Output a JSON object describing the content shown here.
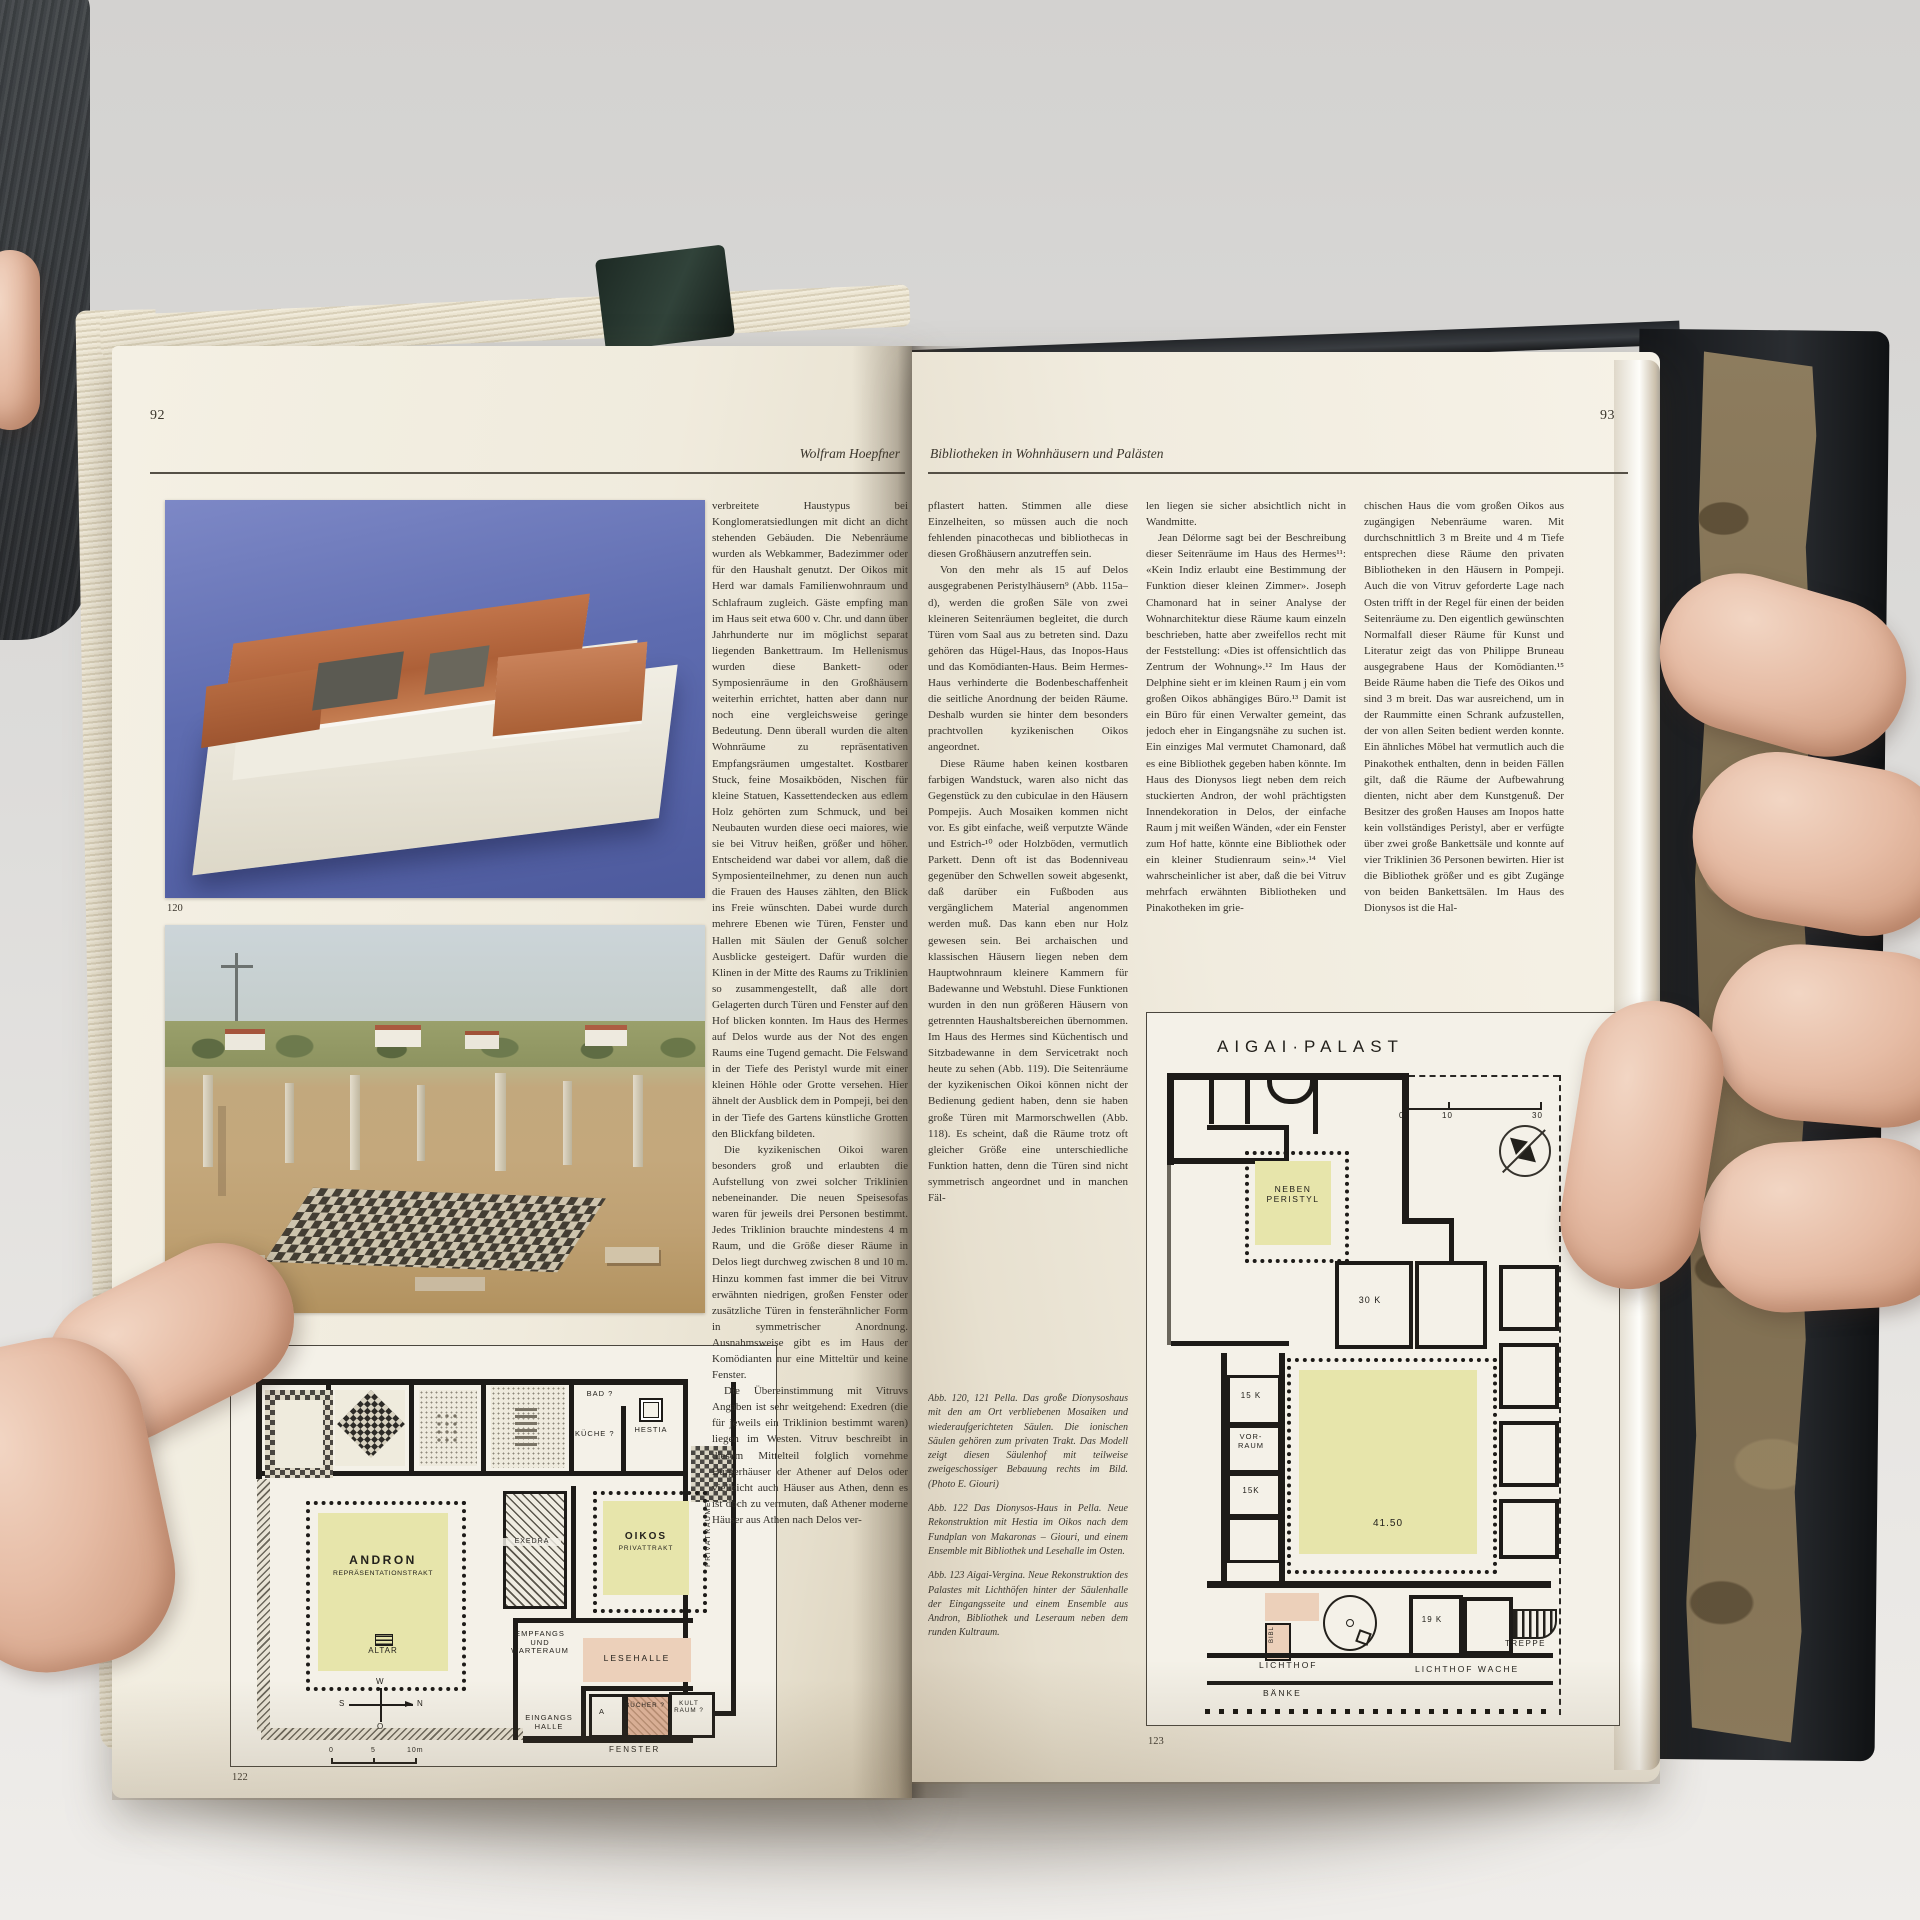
{
  "book": {
    "left_page": {
      "page_number": "92",
      "running_head": "Wolfram Hoepfner",
      "text": {
        "p1": "verbreitete Haustypus bei Konglomeratsiedlungen mit dicht an dicht stehenden Gebäuden. Die Nebenräume wurden als Webkammer, Badezimmer oder für den Haushalt genutzt. Der Oikos mit Herd war damals Familienwohnraum und Schlafraum zugleich. Gäste empfing man im Haus seit etwa 600 v. Chr. und dann über Jahrhunderte nur im möglichst separat liegenden Bankettraum. Im Hellenismus wurden diese Bankett- oder Symposienräume in den Großhäusern weiterhin errichtet, hatten aber dann nur noch eine vergleichsweise geringe Bedeutung. Denn überall wurden die alten Wohnräume zu repräsentativen Empfangsräumen umgestaltet. Kostbarer Stuck, feine Mosaikböden, Nischen für kleine Statuen, Kassettendecken aus edlem Holz gehörten zum Schmuck, und bei Neubauten wurden diese oeci maiores, wie sie bei Vitruv heißen, größer und höher. Entscheidend war dabei vor allem, daß die Symposienteilnehmer, zu denen nun auch die Frauen des Hauses zählten, den Blick ins Freie wünschten. Dabei wurde durch mehrere Ebenen wie Türen, Fenster und Hallen mit Säulen der Genuß solcher Ausblicke gesteigert. Dafür wurden die Klinen in der Mitte des Raums zu Triklinien so zusammengestellt, daß alle dort Gelagerten durch Türen und Fenster auf den Hof blicken konnten. Im Haus des Hermes auf Delos wurde aus der Not des engen Raums eine Tugend gemacht. Die Felswand in der Tiefe des Peristyl wurde mit einer kleinen Höhle oder Grotte versehen. Hier ähnelt der Ausblick dem in Pompeji, bei den in der Tiefe des Gartens künstliche Grotten den Blickfang bildeten.",
        "p2": "Die kyzikenischen Oikoi waren besonders groß und erlaubten die Aufstellung von zwei solcher Triklinien nebeneinander. Die neuen Speisesofas waren für jeweils drei Personen bestimmt. Jedes Triklinion brauchte mindestens 4 m Raum, und die Größe dieser Räume in Delos liegt durchweg zwischen 8 und 10 m. Hinzu kommen fast immer die bei Vitruv erwähnten niedrigen, großen Fenster oder zusätzliche Türen in fensterähnlicher Form in symmetrischer Anordnung. Ausnahmsweise gibt es im Haus der Komödianten nur eine Mitteltür und keine Fenster.",
        "p3": "Die Übereinstimmung mit Vitruvs Angaben ist sehr weitgehend: Exedren (die für jeweils ein Triklinion bestimmt waren) liegen im Westen. Vitruv beschreibt in diesem Mittelteil folglich vornehme Bürgerhäuser der Athener auf Delos oder vielleicht auch Häuser aus Athen, denn es ist doch zu vermuten, daß Athener moderne Häuser aus Athen nach Delos ver-"
      },
      "fig120": {
        "number": "120"
      },
      "fig121": {
        "number": "121"
      },
      "fig122": {
        "number": "122",
        "labels": {
          "bad": "BAD ?",
          "kueche": "KÜCHE ?",
          "hestia": "HESTIA",
          "andron": "ANDRON",
          "andron_sub": "REPRÄSENTATIONSTRAKT",
          "altar": "ALTAR",
          "exedra": "EXEDRA",
          "oikos": "OIKOS",
          "oikos_sub": "PRIVATTRAKT",
          "privatraeume": "PRIVATRÄUME",
          "empfangs": "EMPFANGS UND WARTERAUM",
          "lesehalle": "LESEHALLE",
          "a_room": "A",
          "buecher": "BÜCHER ?",
          "kultraum": "KULT RAUM ?",
          "eingangs": "EINGANGS HALLE",
          "fenster": "FENSTER"
        },
        "compass": {
          "top": "W",
          "right": "N",
          "left": "S",
          "bottom": "O"
        },
        "scale": {
          "s0": "0",
          "s5": "5",
          "s10": "10m"
        }
      }
    },
    "right_page": {
      "page_number": "93",
      "running_head": "Bibliotheken in Wohnhäusern und Palästen",
      "col1": {
        "p1": "pflastert hatten. Stimmen alle diese Einzelheiten, so müssen auch die noch fehlenden pinacothecas und bibliothecas in diesen Großhäusern anzutreffen sein.",
        "p2": "Von den mehr als 15 auf Delos ausgegrabenen Peristylhäusern⁹ (Abb. 115a–d), werden die großen Säle von zwei kleineren Seitenräumen begleitet, die durch Türen vom Saal aus zu betreten sind. Dazu gehören das Hügel-Haus, das Inopos-Haus und das Komödianten-Haus. Beim Hermes-Haus verhinderte die Bodenbeschaffenheit die seitliche Anordnung der beiden Räume. Deshalb wurden sie hinter dem besonders prachtvollen kyzikenischen Oikos angeordnet.",
        "p3": "Diese Räume haben keinen kostbaren farbigen Wandstuck, waren also nicht das Gegenstück zu den cubiculae in den Häusern Pompejis. Auch Mosaiken kommen nicht vor. Es gibt einfache, weiß verputzte Wände und Estrich-¹⁰ oder Holzböden, vermutlich Parkett. Denn oft ist das Bodenniveau gegenüber den Schwellen soweit abgesenkt, daß darüber ein Fußboden aus vergänglichem Material angenommen werden muß. Das kann eben nur Holz gewesen sein. Bei archaischen und klassischen Häusern liegen neben dem Hauptwohnraum kleinere Kammern für Badewanne und Webstuhl. Diese Funktionen wurden in den nun größeren Häusern von getrennten Haushaltsbereichen übernommen. Im Haus des Hermes sind Küchentisch und Sitzbadewanne in dem Servicetrakt noch heute zu sehen (Abb. 119). Die Seitenräume der kyzikenischen Oikoi können nicht der Bedienung gedient haben, denn sie haben große Türen mit Marmorschwellen (Abb. 118). Es scheint, daß die Räume trotz oft gleicher Größe eine unterschiedliche Funktion hatten, denn die Türen sind nicht symmetrisch angeordnet und in manchen Fäl-"
      },
      "captions": {
        "c1": "Abb. 120, 121  Pella. Das große Dionysoshaus mit den am Ort verbliebenen Mosaiken und wiederaufgerichteten Säulen. Die ionischen Säulen gehören zum privaten Trakt. Das Modell zeigt diesen Säulenhof mit teilweise zweigeschossiger Bebauung rechts im Bild. (Photo E. Giouri)",
        "c2": "Abb. 122  Das Dionysos-Haus in Pella. Neue Rekonstruktion mit Hestia im Oikos nach dem Fundplan von Makaronas – Giouri, und einem Ensemble mit Bibliothek und Lesehalle im Osten.",
        "c3": "Abb. 123  Aigai-Vergina. Neue Rekonstruktion des Palastes mit Lichthöfen hinter der Säulenhalle der Eingangsseite und einem Ensemble aus Andron, Bibliothek und Leseraum neben dem runden Kultraum."
      },
      "col2": {
        "p1": "len liegen sie sicher absichtlich nicht in Wandmitte.",
        "p2": "Jean Délorme sagt bei der Beschreibung dieser Seitenräume im Haus des Hermes¹¹: «Kein Indiz erlaubt eine Bestimmung der Funktion dieser kleinen Zimmer». Joseph Chamonard hat in seiner Analyse der Wohnarchitektur diese Räume kaum einzeln beschrieben, hatte aber zweifellos recht mit der Feststellung: «Dies ist offensichtlich das Zentrum der Wohnung».¹² Im Haus der Delphine sieht er im kleinen Raum j ein vom großen Oikos abhängiges Büro.¹³ Damit ist ein Büro für einen Verwalter gemeint, das jedoch eher in Eingangsnähe zu suchen ist. Ein einziges Mal vermutet Chamonard, daß es eine Bibliothek gegeben haben könnte. Im Haus des Dionysos liegt neben dem reich stuckierten Andron, der wohl prächtigsten Innendekoration in Delos, der einfache Raum j mit weißen Wänden, «der ein Fenster zum Hof hatte, könnte eine Bibliothek oder ein kleiner Studienraum sein».¹⁴ Viel wahrscheinlicher ist aber, daß die bei Vitruv mehrfach erwähnten Bibliotheken und Pinakotheken im grie-"
      },
      "col3": {
        "p1": "chischen Haus die vom großen Oikos aus zugängigen Nebenräume waren. Mit durchschnittlich 3 m Breite und 4 m Tiefe entsprechen diese Räume den privaten Bibliotheken in den Häusern in Pompeji. Auch die von Vitruv geforderte Lage nach Osten trifft in der Regel für einen der beiden Seitenräume zu. Den eigentlich gewünschten Normalfall dieser Räume für Kunst und Literatur zeigt das von Philippe Bruneau ausgegrabene Haus der Komödianten.¹⁵ Beide Räume haben die Tiefe des Oikos und sind 3 m breit. Das war ausreichend, um in der Raummitte einen Schrank aufzustellen, der von allen Seiten bedient werden konnte. Ein ähnliches Möbel hat vermutlich auch die Pinakothek enthalten, denn in beiden Fällen gilt, daß die Räume der Aufbewahrung dienten, nicht aber dem Kunstgenuß. Der Besitzer des großen Hauses am Inopos hatte kein vollständiges Peristyl, aber er verfügte über zwei große Bankettsäle und konnte auf vier Triklinien 36 Personen bewirten. Hier ist die Bibliothek größer und es gibt Zugänge von beiden Bankettsälen. Im Haus des Dionysos ist die Hal-"
      },
      "fig123": {
        "number": "123",
        "title": "AIGAI·PALAST",
        "court_label": "41.50",
        "labels": {
          "neben_peristyl": "NEBEN PERISTYL",
          "k30": "30 K",
          "k15a": "15 K",
          "vorraum": "VOR-RAUM",
          "k15b": "15K",
          "k19": "19 K",
          "bibl": "BIBL",
          "lichthof": "LICHTHOF",
          "baenke": "BÄNKE",
          "lichthof_wache": "LICHTHOF WACHE",
          "treppe": "TREPPE"
        },
        "scale": {
          "s0": "0",
          "s10": "10",
          "s30": "30"
        }
      }
    },
    "colors": {
      "paper": "#f2eee1",
      "plan_yellow": "#e7e5ab",
      "plan_salmon": "#ecd0ba",
      "plan_wall": "#1d1b18",
      "model_photo_blue": "#5e6cb0",
      "model_roof_terracotta": "#b96f45"
    }
  }
}
